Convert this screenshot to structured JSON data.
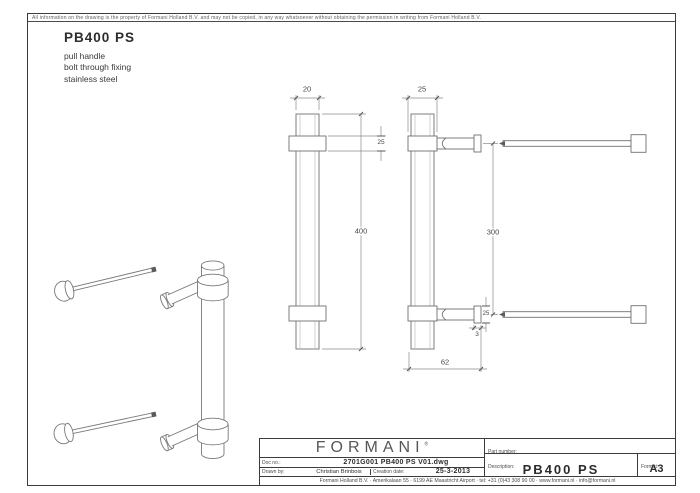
{
  "page": {
    "disclaimer": "All information on the drawing is the property of Formani Holland B.V. and may not be copied, in any way whatsoever without obtaining the permission in writing from Formani Holland B.V."
  },
  "header": {
    "product_code": "PB400 PS",
    "description_lines": {
      "0": "pull handle",
      "1": "bolt through fixing",
      "2": "stainless steel"
    }
  },
  "dimensions": {
    "front_width": "20",
    "front_length": "400",
    "front_collar": "25",
    "side_width": "25",
    "side_centers": "300",
    "side_flange_dia": "25",
    "side_flange_thickness": "3",
    "side_depth": "62"
  },
  "title_block": {
    "brand": "FORMANI",
    "brand_reg": "®",
    "doc_no_label": "Doc no.:",
    "doc_no": "2701G001 PB400 PS V01.dwg",
    "drawn_by_label": "Drawn by:",
    "drawn_by": "Christian Brinbois",
    "creation_date_label": "Creation date:",
    "creation_date": "25-3-2013",
    "part_number_label": "Part number:",
    "part_number": "",
    "description_label": "Description:",
    "description": "PB400 PS",
    "format_label": "Format:",
    "format": "A3",
    "footer": "Formani Holland B.V.  ·  Amerikalaan 55  ·  6199 AE Maastricht Airport  ·  tel: +31 (0)43 308 90 00  ·  www.formani.nl  ·  info@formani.nl"
  },
  "colors": {
    "line": "#707070",
    "dim_line": "#8a8a8a",
    "border": "#3c3c3c",
    "text": "#2c2c2c"
  }
}
